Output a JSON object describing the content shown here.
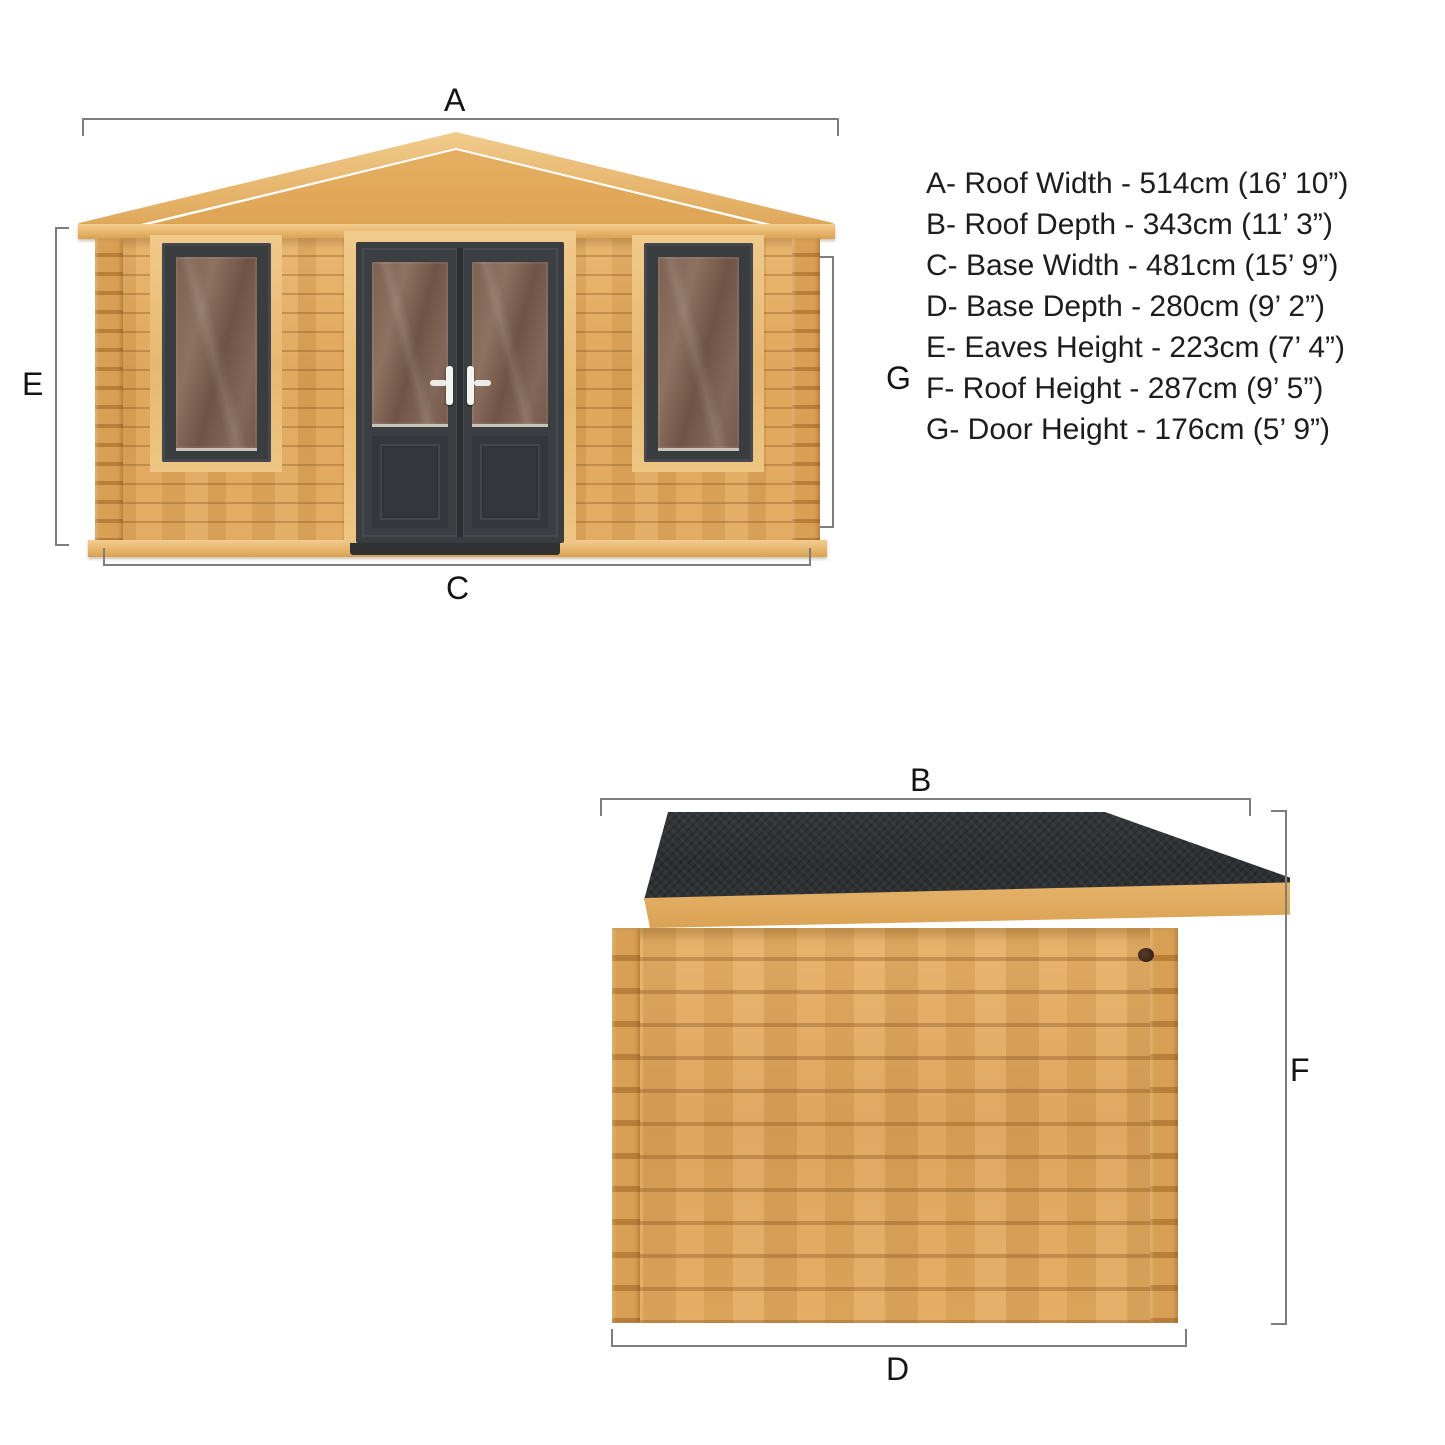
{
  "dimension_labels": {
    "A": "A",
    "B": "B",
    "C": "C",
    "D": "D",
    "E": "E",
    "F": "F",
    "G": "G"
  },
  "dimensions_list": {
    "items": [
      {
        "letter": "A",
        "name": "Roof Width",
        "metric": "514cm",
        "imperial": "16’ 10”",
        "text": "A- Roof Width - 514cm (16’ 10”)"
      },
      {
        "letter": "B",
        "name": "Roof Depth",
        "metric": "343cm",
        "imperial": "11’ 3”",
        "text": "B- Roof Depth - 343cm (11’ 3”)"
      },
      {
        "letter": "C",
        "name": "Base Width",
        "metric": "481cm",
        "imperial": "15’ 9”",
        "text": "C- Base Width - 481cm (15’ 9”)"
      },
      {
        "letter": "D",
        "name": "Base Depth",
        "metric": "280cm",
        "imperial": "9’ 2”",
        "text": "D- Base Depth - 280cm (9’ 2”)"
      },
      {
        "letter": "E",
        "name": "Eaves Height",
        "metric": "223cm",
        "imperial": "7’ 4”",
        "text": "E- Eaves Height - 223cm (7’ 4”)"
      },
      {
        "letter": "F",
        "name": "Roof Height",
        "metric": "287cm",
        "imperial": "9’ 5”",
        "text": "F- Roof Height - 287cm (9’ 5”)"
      },
      {
        "letter": "G",
        "name": "Door Height",
        "metric": "176cm",
        "imperial": "5’ 9”",
        "text": "G- Door Height - 176cm (5’ 9”)"
      }
    ]
  },
  "colors": {
    "wood_light": "#efc377",
    "wood_mid": "#dfa55c",
    "wood_dark": "#c68e44",
    "joinery_dark": "#3a3d40",
    "glass_tint": "#7d6150",
    "roof_felt": "#2d3033",
    "dimension_line": "#7d7d7d",
    "text": "#1d1d1d",
    "handle_white": "#f4f4f2"
  }
}
